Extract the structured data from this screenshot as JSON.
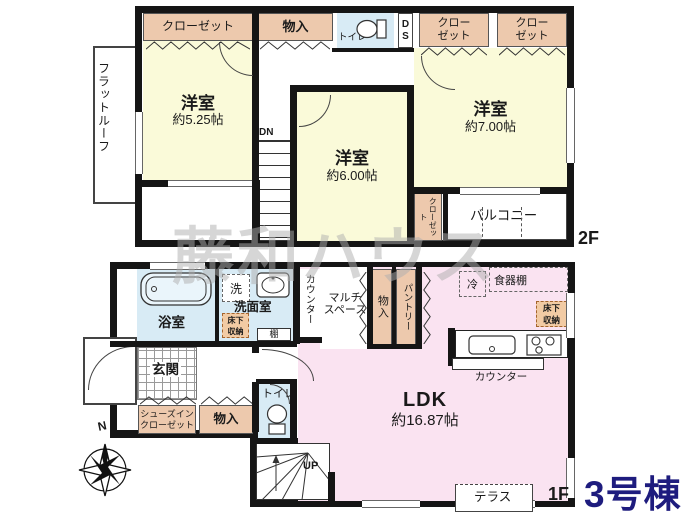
{
  "watermark": "藤和ハウス",
  "building": "3号棟",
  "compass_north": "N",
  "floor2": {
    "label": "2F",
    "flat_roof": "フラットルーフ",
    "closet_top_left": "クローゼット",
    "storage_top": "物入",
    "toilet": "トイレ",
    "duct_space": "D\nS",
    "closet_top_right_1": "クロー\nゼット",
    "closet_top_right_2": "クロー\nゼット",
    "bedroom_small": {
      "name": "洋室",
      "size": "約5.25帖"
    },
    "bedroom_mid": {
      "name": "洋室",
      "size": "約6.00帖"
    },
    "bedroom_large": {
      "name": "洋室",
      "size": "約7.00帖"
    },
    "closet_side": "クローゼット",
    "balcony": "バルコニー",
    "stairs_down": "DN"
  },
  "floor1": {
    "label": "1F",
    "bathroom": "浴室",
    "washer": "洗",
    "washroom": "洗面室",
    "underfloor_storage_left": "床下\n収納",
    "shelf": "棚",
    "counter_side": "カウンター",
    "multi_space": "マルチ\nスペース",
    "storage_mid": "物入",
    "pantry": "パントリー",
    "refrigerator": "冷",
    "cupboard": "食器棚",
    "underfloor_storage_right": "床下\n収納",
    "kitchen_counter": "カウンター",
    "ldk": {
      "name": "LDK",
      "size": "約16.87帖"
    },
    "entrance": "玄関",
    "shoes_closet": "シューズイン\nクローゼット",
    "storage_bottom": "物入",
    "toilet": "トイレ",
    "stairs_up": "UP",
    "terrace": "テラス"
  },
  "colors": {
    "room_yellow": "#FAFAD9",
    "closet_peach": "#EDC9AD",
    "water_blue": "#D8EBF5",
    "ldk_pink": "#FAE3F1",
    "underfloor_orange": "#F2CBA4",
    "wall_black": "#151515",
    "building_navy": "#1E1C7E",
    "watermark_gray": "#AFAFAF"
  }
}
